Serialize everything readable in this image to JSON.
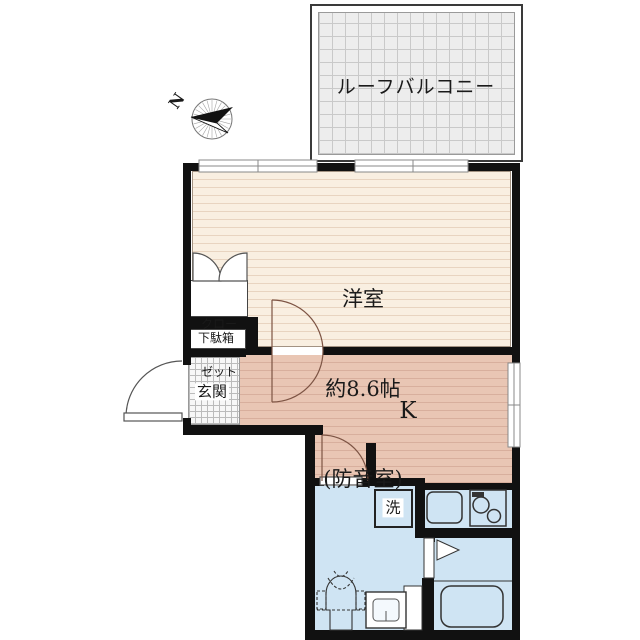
{
  "compass": {
    "north_label": "N"
  },
  "balcony": {
    "label": "ルーフバルコニー"
  },
  "main_room": {
    "name": "洋室",
    "size": "約8.6帖",
    "note": "(防音室)"
  },
  "closet": {
    "line1": "クロー",
    "line2": "ゼット"
  },
  "shoe_box": {
    "label": "下駄箱"
  },
  "entrance": {
    "label": "玄関"
  },
  "kitchen": {
    "label": "K"
  },
  "laundry": {
    "label": "洗"
  },
  "colors": {
    "wall": "#111111",
    "wood_floor": "#f9efe1",
    "kitchen_floor": "#e9c6b4",
    "wet_area_floor": "#cfe4f3",
    "balcony_floor": "#ededed"
  }
}
